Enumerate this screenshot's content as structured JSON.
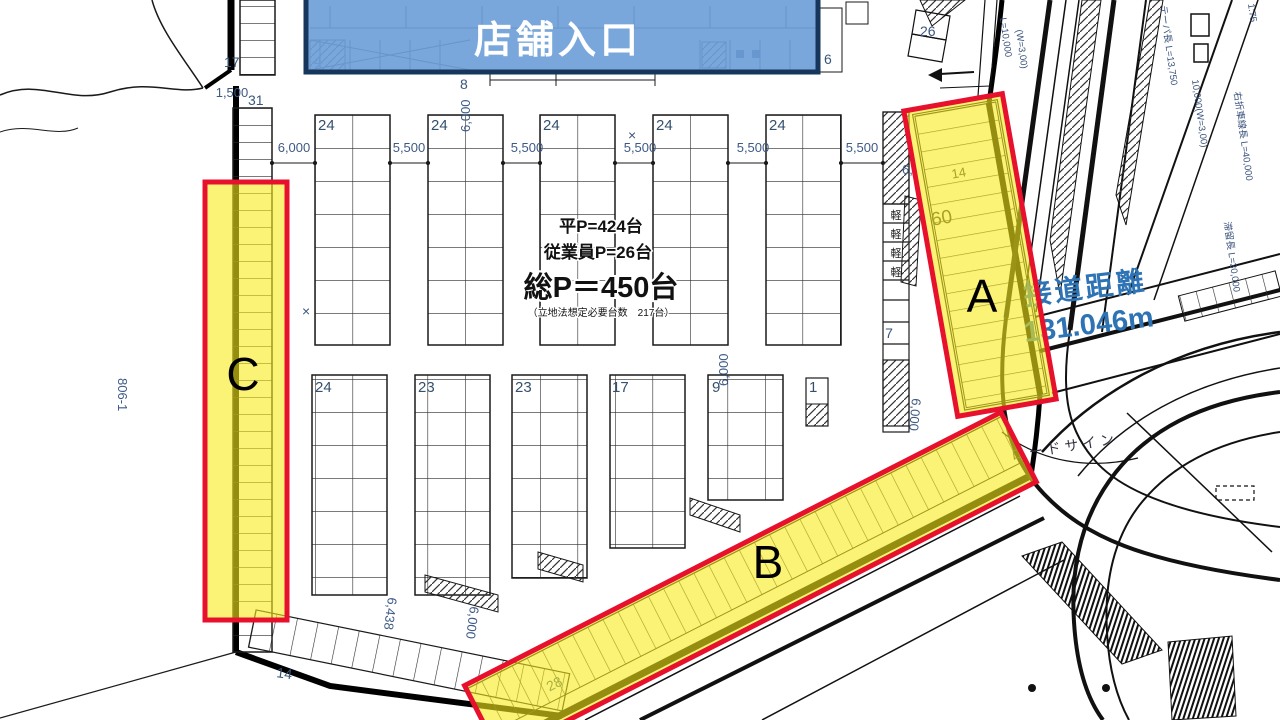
{
  "highlight": {
    "entrance_label": "店舗入口",
    "zone_a": "A",
    "zone_b": "B",
    "zone_c": "C"
  },
  "summary": {
    "flat": "平P=424台",
    "staff": "従業員P=26台",
    "total": "総P＝450台",
    "note": "（立地法想定必要台数　217台）"
  },
  "frontage": {
    "label": "接道距離",
    "value": "131.046m"
  },
  "stall_counts": {
    "upper": [
      "24",
      "24",
      "24",
      "24",
      "24"
    ],
    "lower": [
      "24",
      "23",
      "23",
      "17",
      "9",
      "1"
    ],
    "left_top": "17",
    "left_strip": "31",
    "bottom_row": "14",
    "zone_b": "28",
    "zone_a_outer": "60",
    "zone_a_inner": "14",
    "kei": "軽",
    "right_strip": "7",
    "corner": "26",
    "store_left": "4",
    "store_right": "6",
    "store_below": "8"
  },
  "dimensions": {
    "d1500": "1,500",
    "d6000": "6,000",
    "d5500": "5,500",
    "d6438": "6,438",
    "d6000v": "6,000",
    "d6_partial": "6,",
    "parcel": "806-1"
  },
  "road_labels": {
    "l10000": "L=10,000",
    "w3": "(W=3,00)",
    "ratio": "1:75",
    "taper": "テーパ長 L=13,750",
    "taper2": "10,000(W=3,00)",
    "right_turn": "右折車線長 L=40,000",
    "storage": "滞留長 L=30,000",
    "road_sign": "ロードサイン"
  },
  "marks": {
    "x": "×"
  },
  "colors": {
    "highlight_yellow": "#f7eb19",
    "highlight_blue": "#6f9fd8",
    "border_navy": "#16365c",
    "accent_red": "#e8112d",
    "frontage_blue": "#2e74b5"
  }
}
